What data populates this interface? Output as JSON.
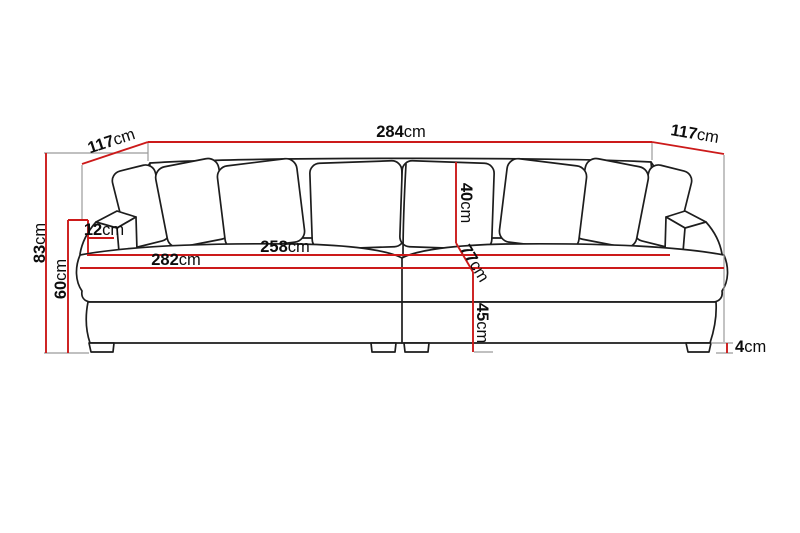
{
  "diagram": {
    "type": "sofa-dimension-drawing",
    "colors": {
      "dimension_line": "#cc1a1a",
      "outline": "#1d1d1d",
      "extension_line": "#9b9b9b",
      "background": "#ffffff"
    },
    "dims": {
      "overall_width": {
        "value": "284",
        "unit": "cm"
      },
      "depth_left": {
        "value": "117",
        "unit": "cm"
      },
      "depth_right": {
        "value": "117",
        "unit": "cm"
      },
      "total_height": {
        "value": "83",
        "unit": "cm"
      },
      "back_height": {
        "value": "60",
        "unit": "cm"
      },
      "arm_width": {
        "value": "12",
        "unit": "cm"
      },
      "inner_width": {
        "value": "258",
        "unit": "cm"
      },
      "seat_width": {
        "value": "282",
        "unit": "cm"
      },
      "cushion_height": {
        "value": "40",
        "unit": "cm"
      },
      "seat_depth": {
        "value": "77",
        "unit": "cm"
      },
      "seat_height": {
        "value": "45",
        "unit": "cm"
      },
      "leg_height": {
        "value": "4",
        "unit": "cm"
      }
    }
  }
}
